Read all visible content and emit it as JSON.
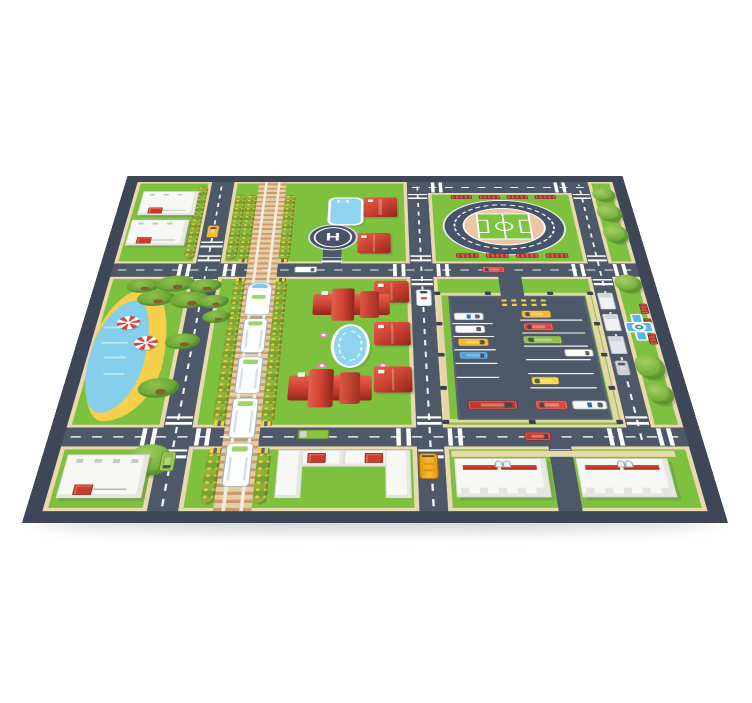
{
  "product": {
    "type": "kids city road play mat",
    "view": "perspective product photo on white background"
  },
  "palette": {
    "mat_border": "#3d4757",
    "road": "#4d5868",
    "grass": "#7ec13f",
    "sidewalk": "#ead9ae",
    "track_bed": "#e7cda4",
    "water_blue": "#86cfec",
    "sand_yellow": "#f6cf4b",
    "roof_red": "#cf4434",
    "building_white": "#f7f7f4",
    "bench_red": "#b03a2e",
    "marking_white": "#ffffff",
    "taxi_yellow": "#f2b630"
  },
  "helipad": {
    "label": "H"
  },
  "scene": {
    "landmarks": [
      "stadium-with-running-track",
      "helipad",
      "train-railway-with-passenger-train",
      "parking-lot",
      "lake-with-beach",
      "red-roof-houses",
      "office-buildings",
      "apartment-blocks",
      "swimming-pool",
      "garden-fountain",
      "plaza-fountain"
    ],
    "items": [
      [
        "cwh",
        83,
        191,
        14,
        24
      ],
      [
        "cwh",
        131,
        191,
        14,
        24
      ],
      [
        "cwv",
        102,
        174,
        24,
        12
      ],
      [
        "cwv",
        102,
        220,
        24,
        12
      ],
      [
        "cwh",
        83,
        464,
        14,
        24
      ],
      [
        "cwh",
        131,
        464,
        14,
        24
      ],
      [
        "cwv",
        102,
        447,
        24,
        12
      ],
      [
        "cwv",
        102,
        493,
        24,
        12
      ],
      [
        "cwh",
        310,
        191,
        14,
        24
      ],
      [
        "cwh",
        356,
        191,
        14,
        24
      ],
      [
        "cwv",
        329,
        174,
        22,
        12
      ],
      [
        "cwv",
        329,
        220,
        22,
        12
      ],
      [
        "cwh",
        310,
        464,
        14,
        24
      ],
      [
        "cwh",
        356,
        464,
        14,
        24
      ],
      [
        "cwv",
        329,
        447,
        22,
        12
      ],
      [
        "cwv",
        329,
        493,
        22,
        12
      ],
      [
        "cwh",
        499,
        191,
        14,
        24
      ],
      [
        "cwh",
        543,
        191,
        14,
        24
      ],
      [
        "cwv",
        518,
        174,
        20,
        12
      ],
      [
        "cwv",
        518,
        220,
        20,
        12
      ],
      [
        "cwh",
        499,
        464,
        14,
        24
      ],
      [
        "cwh",
        543,
        464,
        14,
        24
      ],
      [
        "cwv",
        518,
        447,
        20,
        12
      ],
      [
        "cwv",
        329,
        42,
        22,
        12
      ],
      [
        "cwh",
        356,
        15,
        14,
        24
      ],
      [
        "cwh",
        499,
        15,
        14,
        24
      ],
      [
        "cwv",
        518,
        42,
        20,
        12
      ],
      [
        "cwv",
        234,
        178,
        22,
        10
      ],
      [
        "cwv",
        421,
        220,
        22,
        10
      ],
      [
        "cwv",
        102,
        146,
        24,
        12
      ],
      [
        "cwv",
        445,
        493,
        18,
        10
      ],
      [
        "hedge",
        144,
        44,
        12,
        138
      ],
      [
        "hedge",
        188,
        44,
        12,
        138
      ],
      [
        "hedge",
        131,
        44,
        12,
        138
      ],
      [
        "hedge",
        86,
        24,
        12,
        158
      ],
      [
        "hedge",
        144,
        224,
        12,
        232
      ],
      [
        "hedge",
        188,
        224,
        12,
        232
      ],
      [
        "hedge",
        144,
        496,
        12,
        68
      ],
      [
        "hedge",
        188,
        496,
        12,
        68
      ],
      [
        "hedge",
        366,
        258,
        12,
        188
      ],
      [
        "hedge",
        492,
        258,
        12,
        188
      ],
      [
        "tree",
        541,
        28,
        26,
        32
      ],
      [
        "tree",
        541,
        66,
        28,
        38
      ],
      [
        "tree",
        542,
        110,
        27,
        40
      ],
      [
        "tree",
        540,
        212,
        28,
        34
      ],
      [
        "tree",
        539,
        352,
        28,
        40
      ],
      [
        "tree",
        543,
        398,
        25,
        32
      ],
      [
        "tree",
        76,
        486,
        38,
        42
      ],
      [
        "palm",
        34,
        220,
        34,
        26
      ],
      [
        "palm",
        64,
        214,
        40,
        30
      ],
      [
        "palm",
        98,
        220,
        34,
        26
      ],
      [
        "palm",
        48,
        242,
        38,
        28
      ],
      [
        "palm",
        82,
        244,
        40,
        30
      ],
      [
        "palm",
        112,
        250,
        30,
        24
      ],
      [
        "palm",
        118,
        278,
        28,
        22
      ],
      [
        "palm",
        86,
        318,
        34,
        26
      ],
      [
        "palm",
        70,
        390,
        38,
        30
      ],
      [
        "bench",
        378,
        45,
        24,
        9
      ],
      [
        "bench",
        410,
        45,
        24,
        9
      ],
      [
        "bench",
        442,
        45,
        24,
        9
      ],
      [
        "bench",
        474,
        45,
        24,
        9
      ],
      [
        "bench",
        378,
        170,
        24,
        9
      ],
      [
        "bench",
        410,
        170,
        24,
        9
      ],
      [
        "bench",
        442,
        170,
        24,
        9
      ],
      [
        "bench",
        474,
        170,
        24,
        9
      ],
      [
        "bench",
        559,
        266,
        8,
        18,
        {
          "v": 1
        }
      ],
      [
        "bench",
        559,
        292,
        8,
        18,
        {
          "v": 1
        }
      ],
      [
        "bench",
        559,
        318,
        8,
        18,
        {
          "v": 1
        }
      ],
      [
        "umb",
        34,
        288,
        23,
        23
      ],
      [
        "umb",
        56,
        322,
        23,
        23
      ],
      [
        "fly",
        285,
        58,
        10,
        10
      ],
      [
        "fly",
        285,
        78,
        10,
        10
      ],
      [
        "flp",
        236,
        316,
        9,
        9
      ],
      [
        "flp",
        294,
        316,
        9,
        9
      ],
      [
        "flp",
        236,
        366,
        9,
        9
      ],
      [
        "flp",
        294,
        366,
        9,
        9
      ],
      [
        "wave",
        22,
        306,
        18,
        3
      ],
      [
        "wave",
        24,
        332,
        26,
        3
      ],
      [
        "wave",
        30,
        356,
        22,
        3
      ],
      [
        "wave",
        34,
        382,
        20,
        3
      ],
      [
        "bldg",
        24,
        36,
        64,
        54,
        {
          "u": [
            10,
            36
          ]
        }
      ],
      [
        "bldg",
        20,
        100,
        64,
        54,
        {
          "u": [
            10,
            36
          ]
        }
      ],
      [
        "bldg",
        22,
        500,
        72,
        56,
        {
          "u": [
            12,
            38
          ]
        }
      ],
      [
        "kiosk",
        374,
        258,
        38,
        40
      ],
      [
        "lb",
        206,
        494,
        60,
        62,
        {
          "parts": [
            [
              0,
              0,
              58,
              22
            ],
            [
              0,
              0,
              22,
              62
            ]
          ],
          "u": [
            26,
            4
          ]
        }
      ],
      [
        "lb",
        262,
        494,
        60,
        62,
        {
          "parts": [
            [
              2,
              0,
              58,
              22
            ],
            [
              38,
              0,
              22,
              62
            ]
          ],
          "u": [
            20,
            4
          ]
        }
      ],
      [
        "path",
        358,
        495,
        196,
        8
      ],
      [
        "apt",
        360,
        505,
        80,
        50
      ],
      [
        "apt",
        466,
        505,
        80,
        50
      ],
      [
        "hs",
        278,
        50,
        38,
        44
      ],
      [
        "hs",
        272,
        128,
        36,
        42
      ],
      [
        "hs",
        290,
        224,
        36,
        40
      ],
      [
        "hs",
        290,
        298,
        36,
        40
      ],
      [
        "hs",
        290,
        372,
        36,
        40
      ],
      [
        "manor",
        228,
        238,
        78,
        58
      ],
      [
        "manor",
        210,
        376,
        78,
        58
      ],
      [
        "poolr",
        238,
        50,
        40,
        62
      ],
      [
        "poolo",
        248,
        302,
        38,
        72
      ],
      [
        "fount",
        539,
        284,
        28,
        46
      ],
      [
        "ring",
        354,
        246,
        158,
        210
      ],
      [
        "post",
        352,
        244,
        6,
        6
      ],
      [
        "post",
        404,
        244,
        6,
        6
      ],
      [
        "post",
        468,
        244,
        6,
        6
      ],
      [
        "post",
        509,
        244,
        6,
        6
      ],
      [
        "post",
        352,
        298,
        6,
        6
      ],
      [
        "post",
        509,
        298,
        6,
        6
      ],
      [
        "post",
        352,
        350,
        6,
        6
      ],
      [
        "post",
        509,
        350,
        6,
        6
      ],
      [
        "post",
        352,
        402,
        6,
        6
      ],
      [
        "post",
        509,
        402,
        6,
        6
      ],
      [
        "post",
        352,
        452,
        6,
        6
      ],
      [
        "post",
        430,
        452,
        6,
        6
      ],
      [
        "post",
        509,
        452,
        6,
        6
      ],
      [
        "lot",
        366,
        252,
        140,
        200
      ],
      [
        "patch",
        420,
        216,
        24,
        42,
        {
          "z": 4
        }
      ],
      [
        "ydash",
        420,
        258,
        46,
        4,
        {
          "z": 5
        }
      ],
      [
        "ydash",
        420,
        266,
        46,
        4,
        {
          "z": 5
        }
      ],
      [
        "pline",
        368,
        300,
        40,
        2
      ],
      [
        "pline",
        368,
        322,
        40,
        2
      ],
      [
        "pline",
        368,
        344,
        40,
        2
      ],
      [
        "pline",
        368,
        366,
        40,
        2
      ],
      [
        "pline",
        368,
        388,
        40,
        2
      ],
      [
        "pline",
        436,
        294,
        62,
        2
      ],
      [
        "pline",
        436,
        316,
        62,
        2
      ],
      [
        "pline",
        436,
        338,
        62,
        2
      ],
      [
        "pline",
        436,
        360,
        62,
        2
      ],
      [
        "pline",
        436,
        382,
        62,
        2
      ],
      [
        "pline",
        436,
        404,
        62,
        2
      ],
      [
        "car",
        370,
        282,
        30,
        13,
        {
          "c": "#f4f7f9",
          "dir": "e",
          "pol": 1
        }
      ],
      [
        "car",
        370,
        304,
        30,
        13,
        {
          "c": "#fbfbf9",
          "dir": "e"
        }
      ],
      [
        "car",
        372,
        326,
        30,
        13,
        {
          "c": "#f2b630",
          "dir": "e"
        }
      ],
      [
        "car",
        372,
        348,
        28,
        12,
        {
          "c": "#4aa3df",
          "dir": "e"
        }
      ],
      [
        "car",
        376,
        424,
        46,
        13,
        {
          "c": "#c2392b",
          "dir": "e"
        }
      ],
      [
        "car",
        438,
        278,
        30,
        13,
        {
          "c": "#f2b630",
          "dir": "w"
        }
      ],
      [
        "car",
        438,
        300,
        30,
        13,
        {
          "c": "#d84a3d",
          "dir": "w"
        }
      ],
      [
        "car",
        436,
        322,
        38,
        13,
        {
          "c": "#8cc341",
          "dir": "w"
        }
      ],
      [
        "car",
        474,
        344,
        28,
        12,
        {
          "c": "#fbfbf9",
          "dir": "e"
        }
      ],
      [
        "car",
        438,
        388,
        26,
        12,
        {
          "c": "#f5d44a",
          "dir": "w"
        }
      ],
      [
        "car",
        438,
        424,
        30,
        13,
        {
          "c": "#d84a3d",
          "dir": "w"
        }
      ],
      [
        "car",
        472,
        424,
        32,
        13,
        {
          "c": "#f4f7f9",
          "dir": "e",
          "pol": 1
        }
      ],
      [
        "car",
        106,
        112,
        13,
        26,
        {
          "c": "#f2b630",
          "dir": "n"
        }
      ],
      [
        "car",
        206,
        196,
        24,
        12,
        {
          "c": "#fbfbf9",
          "dir": "e"
        }
      ],
      [
        "car",
        404,
        196,
        24,
        12,
        {
          "c": "#d84a3d",
          "dir": "w"
        }
      ],
      [
        "amb",
        333,
        240,
        16,
        30
      ],
      [
        "car",
        424,
        469,
        24,
        12,
        {
          "c": "#c8382e",
          "dir": "e"
        }
      ],
      [
        "truck",
        222,
        466,
        28,
        13,
        {
          "c": "#8cc341",
          "dir": "w"
        }
      ],
      [
        "car",
        104,
        496,
        13,
        26,
        {
          "c": "#8cc341",
          "dir": "s"
        }
      ],
      [
        "bus",
        329,
        498,
        17,
        34
      ],
      [
        "truck",
        519,
        246,
        16,
        30,
        {
          "c": "#eef1f3",
          "dir": "n"
        }
      ],
      [
        "truck",
        519,
        284,
        16,
        30,
        {
          "c": "#eef1f3",
          "dir": "n"
        }
      ],
      [
        "truck",
        519,
        322,
        16,
        30,
        {
          "c": "#e3e7ea",
          "dir": "n"
        }
      ],
      [
        "car",
        520,
        362,
        13,
        24,
        {
          "c": "#c6ccd2",
          "dir": "n"
        }
      ],
      [
        "xpost",
        146,
        181,
        10,
        7
      ],
      [
        "xpost",
        188,
        181,
        10,
        7
      ],
      [
        "xpost",
        146,
        218,
        10,
        7
      ],
      [
        "xpost",
        188,
        218,
        10,
        7
      ],
      [
        "xpost",
        146,
        454,
        10,
        7
      ],
      [
        "xpost",
        188,
        454,
        10,
        7
      ],
      [
        "xpost",
        146,
        491,
        10,
        7
      ],
      [
        "xpost",
        188,
        491,
        10,
        7
      ],
      [
        "loco",
        159,
        226,
        26,
        60,
        {
          "z": 5
        }
      ],
      [
        "tcar",
        160,
        292,
        24,
        58,
        {
          "z": 5
        }
      ],
      [
        "tcar",
        160,
        356,
        24,
        58,
        {
          "z": 5
        }
      ],
      [
        "tcar",
        160,
        420,
        24,
        58,
        {
          "z": 5
        }
      ],
      [
        "tcar",
        160,
        484,
        24,
        58,
        {
          "z": 5
        }
      ]
    ]
  }
}
